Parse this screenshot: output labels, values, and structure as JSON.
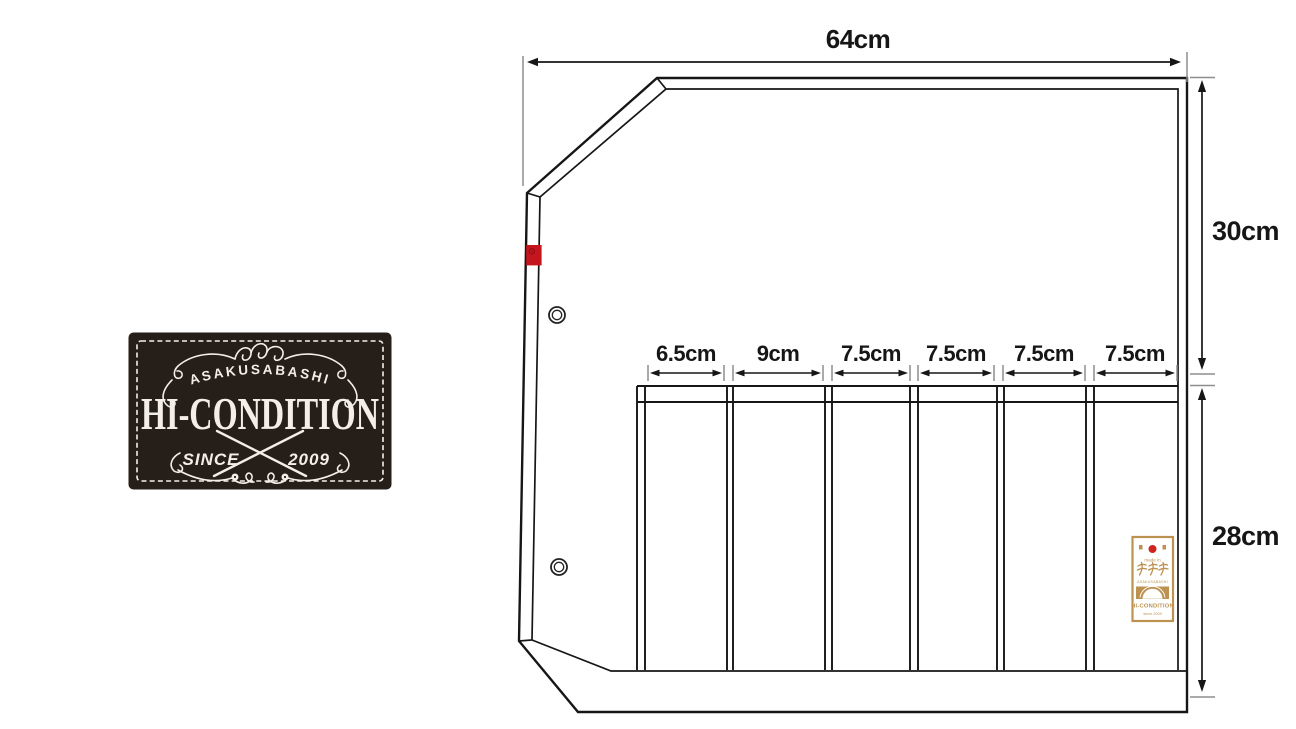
{
  "page": {
    "background": "#ffffff"
  },
  "logo": {
    "arch_text": "ASAKUSABASHI",
    "main_text": "HI-CONDITION",
    "since_text": "SINCE",
    "year_text": "2009",
    "bg_color": "#261e18",
    "ink_color": "#f3efe8"
  },
  "diagram": {
    "top_width_label": "64cm",
    "upper_height_label": "30cm",
    "lower_height_label": "28cm",
    "pocket_width_labels": [
      "6.5cm",
      "9cm",
      "7.5cm",
      "7.5cm",
      "7.5cm",
      "7.5cm"
    ],
    "line_color": "#161616",
    "tick_color": "#8d8d8d",
    "snap_patch_color": "#c5161d"
  },
  "care_label": {
    "made_in": "made in",
    "kanji": "浅草橋",
    "romaji": "ASAKUSABASHI",
    "brand": "HI-CONDITION",
    "since": "since 2009",
    "gold_color": "#bd9251",
    "red_dot_color": "#d02423"
  }
}
